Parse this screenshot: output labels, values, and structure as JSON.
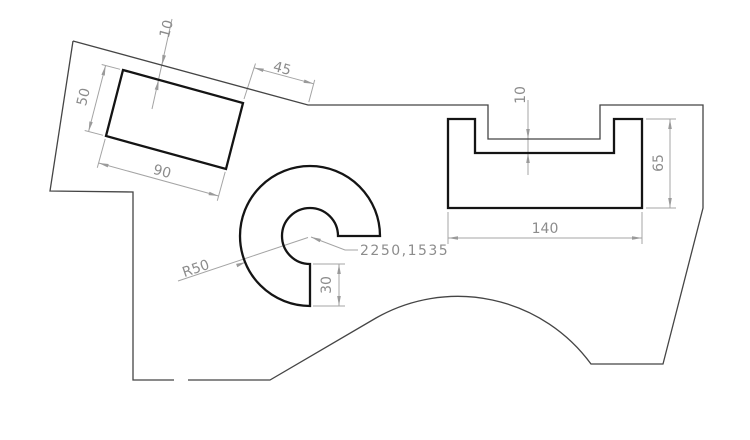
{
  "drawing": {
    "background_color": "#ffffff",
    "outline_color": "#454545",
    "feature_color": "#141414",
    "dimension_color": "#a4a4a4",
    "text_color": "#8c8c8c"
  },
  "dims": {
    "rect_offset": "10",
    "slope_length": "45",
    "rect_height": "50",
    "rect_width": "90",
    "radius": "R50",
    "center_point": "2250,1535",
    "sector_width": "30",
    "slot_gap": "10",
    "channel_width": "140",
    "channel_height": "65"
  }
}
